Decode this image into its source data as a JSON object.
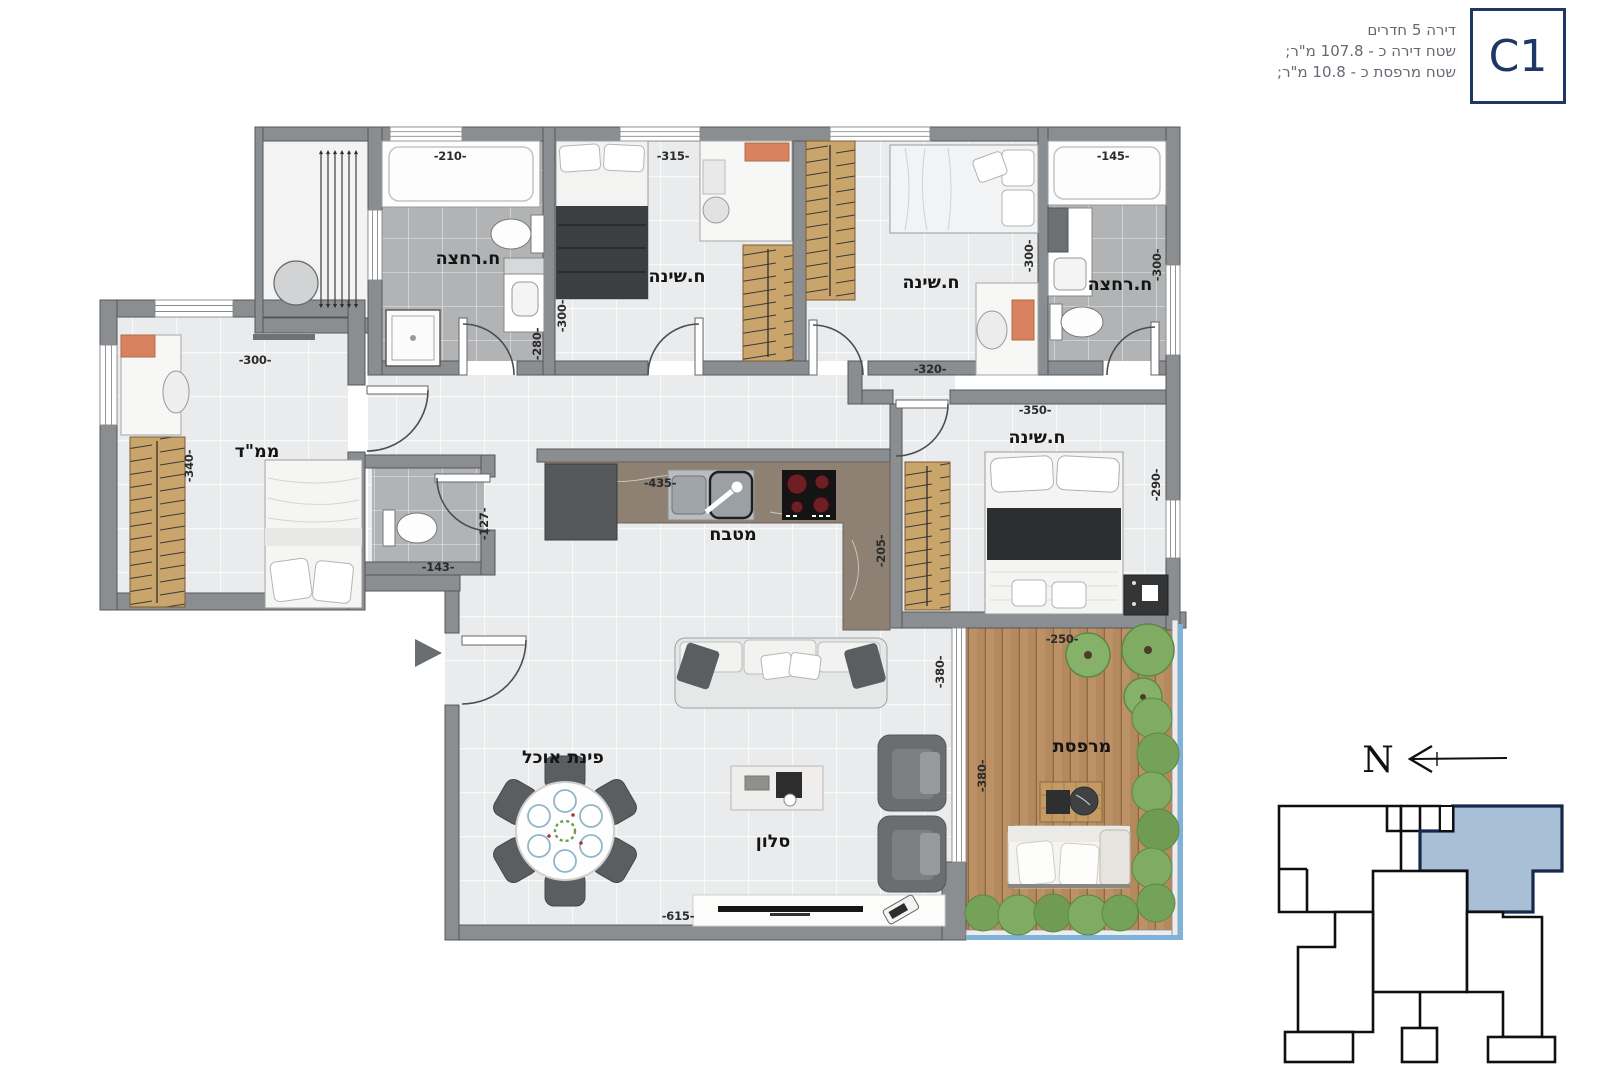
{
  "header": {
    "line1": "דירה 5 חדרים",
    "line2": "שטח דירה כ - 107.8 מ\"ר;",
    "line3": "שטח מרפסת כ - 10.8 מ\"ר;",
    "unit": "C1"
  },
  "compass": {
    "north": "N"
  },
  "rooms": {
    "bathroom1": "ח.רחצה",
    "bedroom1": "ח.שינה",
    "bedroom2": "ח.שינה",
    "bathroom2": "ח.רחצה",
    "safe_room": "ממ\"ד",
    "kitchen": "מטבח",
    "master_bedroom": "ח.שינה",
    "dining": "פינת אוכל",
    "living": "סלון",
    "balcony": "מרפסת"
  },
  "dimensions": {
    "bath1_top": "-210-",
    "bed1_top": "-315-",
    "bath2_top": "-145-",
    "bed1_left": "-300-",
    "hall_280": "-280-",
    "bed2_right": "-300-",
    "bath2_right": "-300-",
    "bed2_bottom": "-320-",
    "master_top": "-350-",
    "mamad_top": "-300-",
    "mamad_left": "-340-",
    "wc_right": "-127-",
    "wc_bottom": "-143-",
    "kitchen_top": "-435-",
    "kitchen_side": "-205-",
    "master_right": "-290-",
    "living_right": "-380-",
    "balcony_top": "-250-",
    "balcony_left": "-380-",
    "living_bottom": "-615-"
  },
  "colors": {
    "accent_navy": "#1e3766",
    "keyplan_highlight": "#a9bfd5",
    "wall_gray": "#8b8e90",
    "tile_light": "#eaebec",
    "tile_dark": "#b1b3b5",
    "wood": "#c9a46b",
    "deck": "#b5895e",
    "plant_green": "#7fae66",
    "balcony_glass": "#7fb2d9",
    "burner_red": "#6e1f24",
    "accent_orange": "#d8825f"
  }
}
